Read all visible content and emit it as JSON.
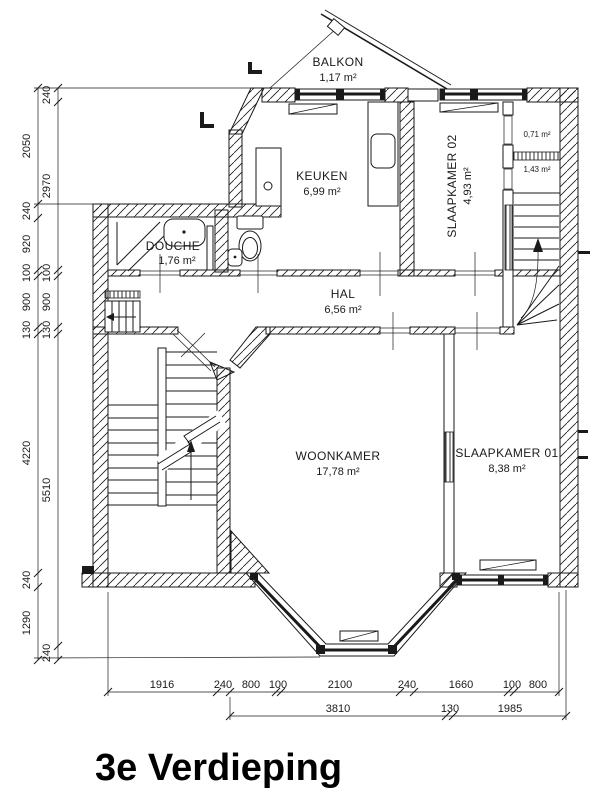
{
  "title": "3e Verdieping",
  "rooms": {
    "balkon": {
      "name": "BALKON",
      "area": "1,17 m²"
    },
    "keuken": {
      "name": "KEUKEN",
      "area": "6,99 m²"
    },
    "slaapkamer02": {
      "name": "SLAAPKAMER 02",
      "area": "4,93 m²"
    },
    "kast_klein": {
      "area": "0,71 m²"
    },
    "kast_groot": {
      "area": "1,43 m²"
    },
    "douche": {
      "name": "DOUCHE",
      "area": "1,76 m²"
    },
    "hal": {
      "name": "HAL",
      "area": "6,56 m²"
    },
    "woonkamer": {
      "name": "WOONKAMER",
      "area": "17,78 m²"
    },
    "slaapkamer01": {
      "name": "SLAAPKAMER 01",
      "area": "8,38 m²"
    }
  },
  "dimensions": {
    "left_outer": [
      "2050",
      "240",
      "920",
      "100",
      "900",
      "130",
      "4220",
      "240",
      "1290"
    ],
    "left_inner": [
      "240",
      "2970",
      "100",
      "900",
      "130",
      "5510",
      "240"
    ],
    "bottom_row1": [
      "1916",
      "240",
      "800",
      "100",
      "2100",
      "240",
      "1660",
      "100",
      "800"
    ],
    "bottom_row2": [
      "3810",
      "130",
      "1985"
    ]
  },
  "colors": {
    "ink": "#1a1a1a",
    "background": "#ffffff"
  }
}
